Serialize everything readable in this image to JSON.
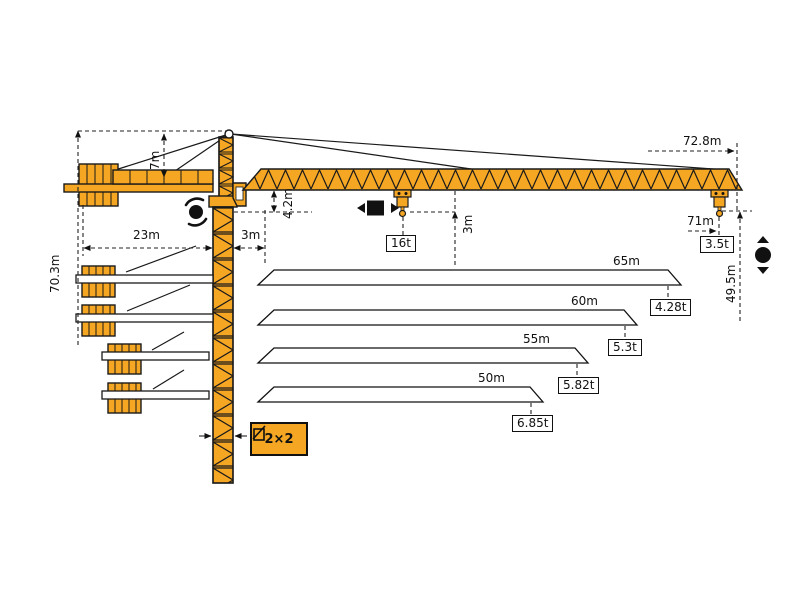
{
  "diagram": {
    "type": "tower-crane-specification-diagram",
    "colors": {
      "crane_orange": "#F5A623",
      "outline": "#1A1A1A",
      "dimension_lines": "#222222"
    },
    "dims": {
      "total_height": "70.3m",
      "tower_head_height": "7m",
      "counterjib_radius": "23m",
      "rear_offset": "3m",
      "jib_root_depth": "4.2m",
      "hook_drop": "3m",
      "max_radius": "72.8m",
      "tip_hook_radius": "71m",
      "hook_height": "49.5m",
      "mast_section": "2×2"
    },
    "loads": {
      "max_load": "16t",
      "tip_load": "3.5t"
    },
    "jib_options": [
      {
        "length": "65m",
        "tip_load": "4.28t"
      },
      {
        "length": "60m",
        "tip_load": "5.3t"
      },
      {
        "length": "55m",
        "tip_load": "5.82t"
      },
      {
        "length": "50m",
        "tip_load": "6.85t"
      }
    ],
    "icons": {
      "slewing": "slewing-rotation-icon",
      "trolley": "trolley-travel-icon",
      "hoist": "hoist-up-down-icon",
      "mast_section": "mast-section-icon"
    }
  }
}
